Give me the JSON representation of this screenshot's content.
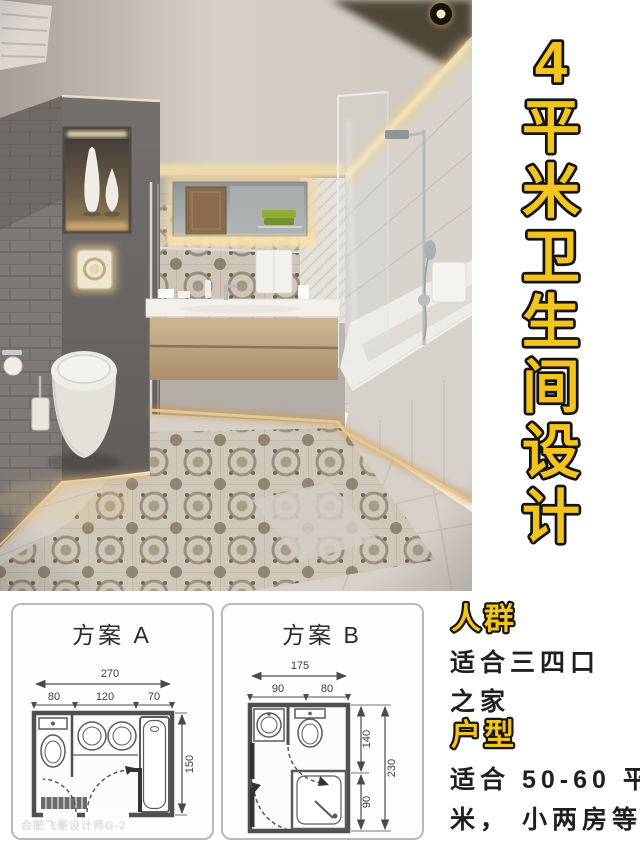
{
  "title": {
    "text": "4平米卫生间设计",
    "chars": [
      "4",
      "平",
      "米",
      "卫",
      "生",
      "间",
      "设",
      "计"
    ],
    "fill": "#f4c41e",
    "outline": "#141414"
  },
  "plan_a": {
    "label": "方案 A",
    "total_width": "270",
    "seg1": "80",
    "seg2": "120",
    "seg3": "70",
    "height": "150"
  },
  "plan_b": {
    "label": "方案 B",
    "total_width": "175",
    "seg1": "90",
    "seg2": "80",
    "right_upper": "140",
    "right_lower": "90",
    "total_height": "230"
  },
  "info": {
    "audience_label": "人群",
    "audience_line1": "适合三四口",
    "audience_line2": "之家",
    "layout_label": "户型",
    "layout_line1": "适合 50-60 平",
    "layout_line2": "米， 小两房等"
  },
  "watermark": "合肥飞墨设计师G-2",
  "colors": {
    "accent_yellow": "#f4c41e",
    "text_dark": "#1f1f1f",
    "plan_line": "#4a4a4a"
  }
}
